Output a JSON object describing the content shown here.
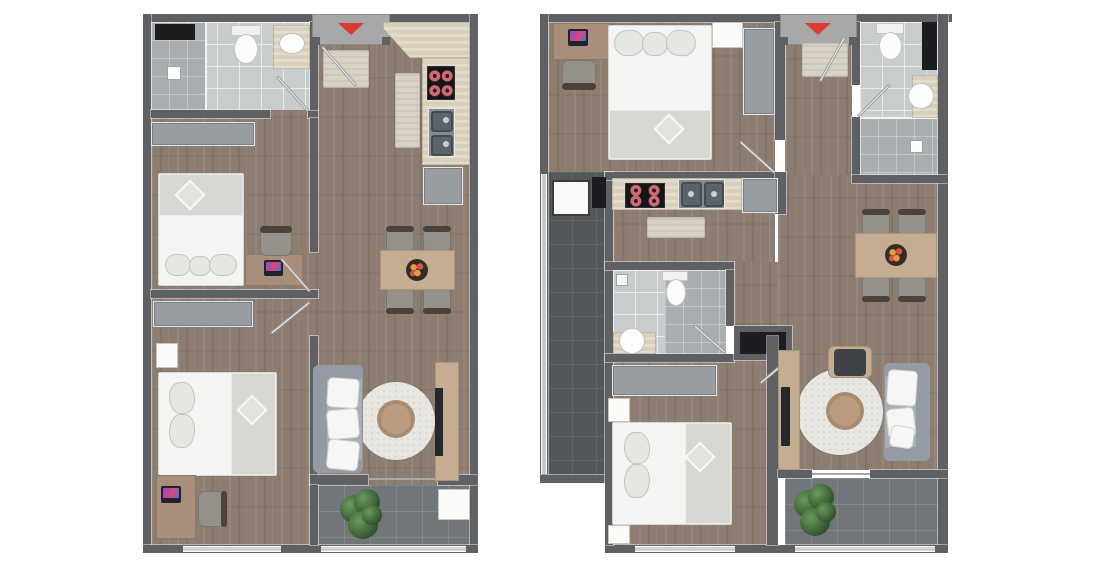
{
  "canvas": {
    "width": 1100,
    "height": 571,
    "background": "#ffffff"
  },
  "colors": {
    "bg": "#ffffff",
    "wall": "#5f6064",
    "wallLight": "#a8a8a8",
    "wood": "#8c7d70",
    "tile": "#c9cccd",
    "tileShower": "#a9aeb1",
    "balconyTile": "#70767a",
    "terraceTile": "#53585b",
    "counter": "#d9cfba",
    "mat": "#d8d2c6",
    "furnGray": "#979da1",
    "bedWhite": "#f4f4f2",
    "blanket": "#d8d7d2",
    "pillow": "#e5e5e2",
    "desk": "#a98f7b",
    "table": "#c5ad92",
    "coffeeTable": "#bb9c7e",
    "rug": "#e8e6e1",
    "sofa": "#a9aeb6",
    "sofaDark": "#959ba4",
    "chairSeat": "#93918a",
    "chairBack": "#4b423b",
    "red": "#dc3b2f",
    "stove": "#161618",
    "burner": "#cf6b74",
    "appliance": "#848b90",
    "dark": "#1b1d1f",
    "rugWhite": "#e8e6e1",
    "plantLight": "#6a9a5d",
    "plantDark": "#2f4f2a",
    "bowl": "#342b25",
    "fruitOrange": "#e8993e",
    "fruitRed": "#d65440",
    "tv": "#24282c"
  },
  "plans": [
    {
      "id": "plan-a",
      "side": "left",
      "entrance_marker": "red-arrow-down",
      "rooms": [
        "bathroom-with-shower",
        "bedroom-1",
        "bedroom-2",
        "kitchen",
        "living-dining",
        "balcony",
        "entry-hall"
      ],
      "fixtures": [
        "toilet",
        "vanity-sink",
        "shower",
        "wardrobe",
        "double-bed",
        "desk-with-laptop",
        "desk-chair",
        "second-double-bed",
        "nightstand",
        "second-desk-with-laptop",
        "dining-table-with-4-chairs",
        "fruit-bowl",
        "fridge",
        "stove-4-burners",
        "double-kitchen-sink",
        "kitchen-mat",
        "doormat",
        "sofa",
        "round-rug",
        "round-coffee-table",
        "tv-stand-with-tv",
        "potted-plant",
        "balcony-cabinet"
      ]
    },
    {
      "id": "plan-b",
      "side": "right",
      "entrance_marker": "red-arrow-down",
      "rooms": [
        "bedroom-1",
        "bathroom-1",
        "entry-hall",
        "kitchen",
        "utility-terrace",
        "bathroom-2",
        "bedroom-2",
        "living-dining",
        "balcony"
      ],
      "fixtures": [
        "desk-with-laptop",
        "desk-chair",
        "double-bed",
        "nightstand",
        "wardrobe",
        "toilet",
        "vanity-sink",
        "shower",
        "storage-niche",
        "washing-machine",
        "stove-4-burners",
        "double-kitchen-sink",
        "fridge",
        "kitchen-mat",
        "doormat",
        "second-toilet",
        "round-sink",
        "second-double-bed",
        "two-nightstands",
        "dining-table-with-4-chairs",
        "fruit-bowl",
        "tv-stand-with-tv",
        "armchair",
        "round-rug",
        "round-coffee-table",
        "sofa",
        "potted-plant"
      ]
    }
  ]
}
